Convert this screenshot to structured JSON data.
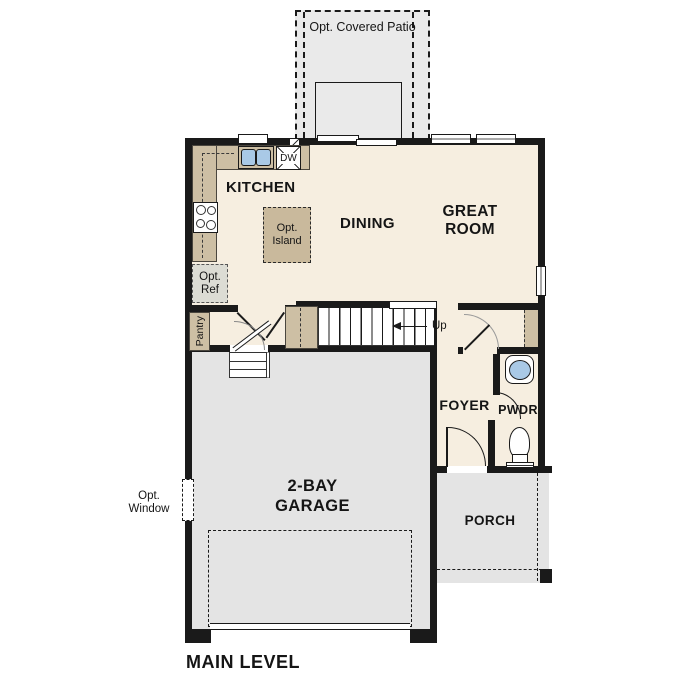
{
  "floor_plan": {
    "title": "MAIN LEVEL",
    "rooms": {
      "kitchen": "KITCHEN",
      "dining": "DINING",
      "great_room_line1": "GREAT",
      "great_room_line2": "ROOM",
      "foyer": "FOYER",
      "powder": "PWDR",
      "garage_line1": "2-BAY",
      "garage_line2": "GARAGE",
      "porch": "PORCH",
      "pantry": "Pantry"
    },
    "options": {
      "covered_patio": "Opt. Covered Patio",
      "island_line1": "Opt.",
      "island_line2": "Island",
      "ref_line1": "Opt.",
      "ref_line2": "Ref",
      "window_line1": "Opt.",
      "window_line2": "Window"
    },
    "fixtures": {
      "dishwasher": "DW",
      "stairs_direction": "Up"
    },
    "colors": {
      "wall": "#1a1a1a",
      "interior_floor": "#f6eee0",
      "counter_tan": "#cdbfa4",
      "island_tan": "#c9b99c",
      "garage_gray": "#e4e4e4",
      "patio_gray": "#eaeaea",
      "optional_item_gray": "#dcdcd4",
      "sink_blue": "#a9c9e6"
    }
  }
}
